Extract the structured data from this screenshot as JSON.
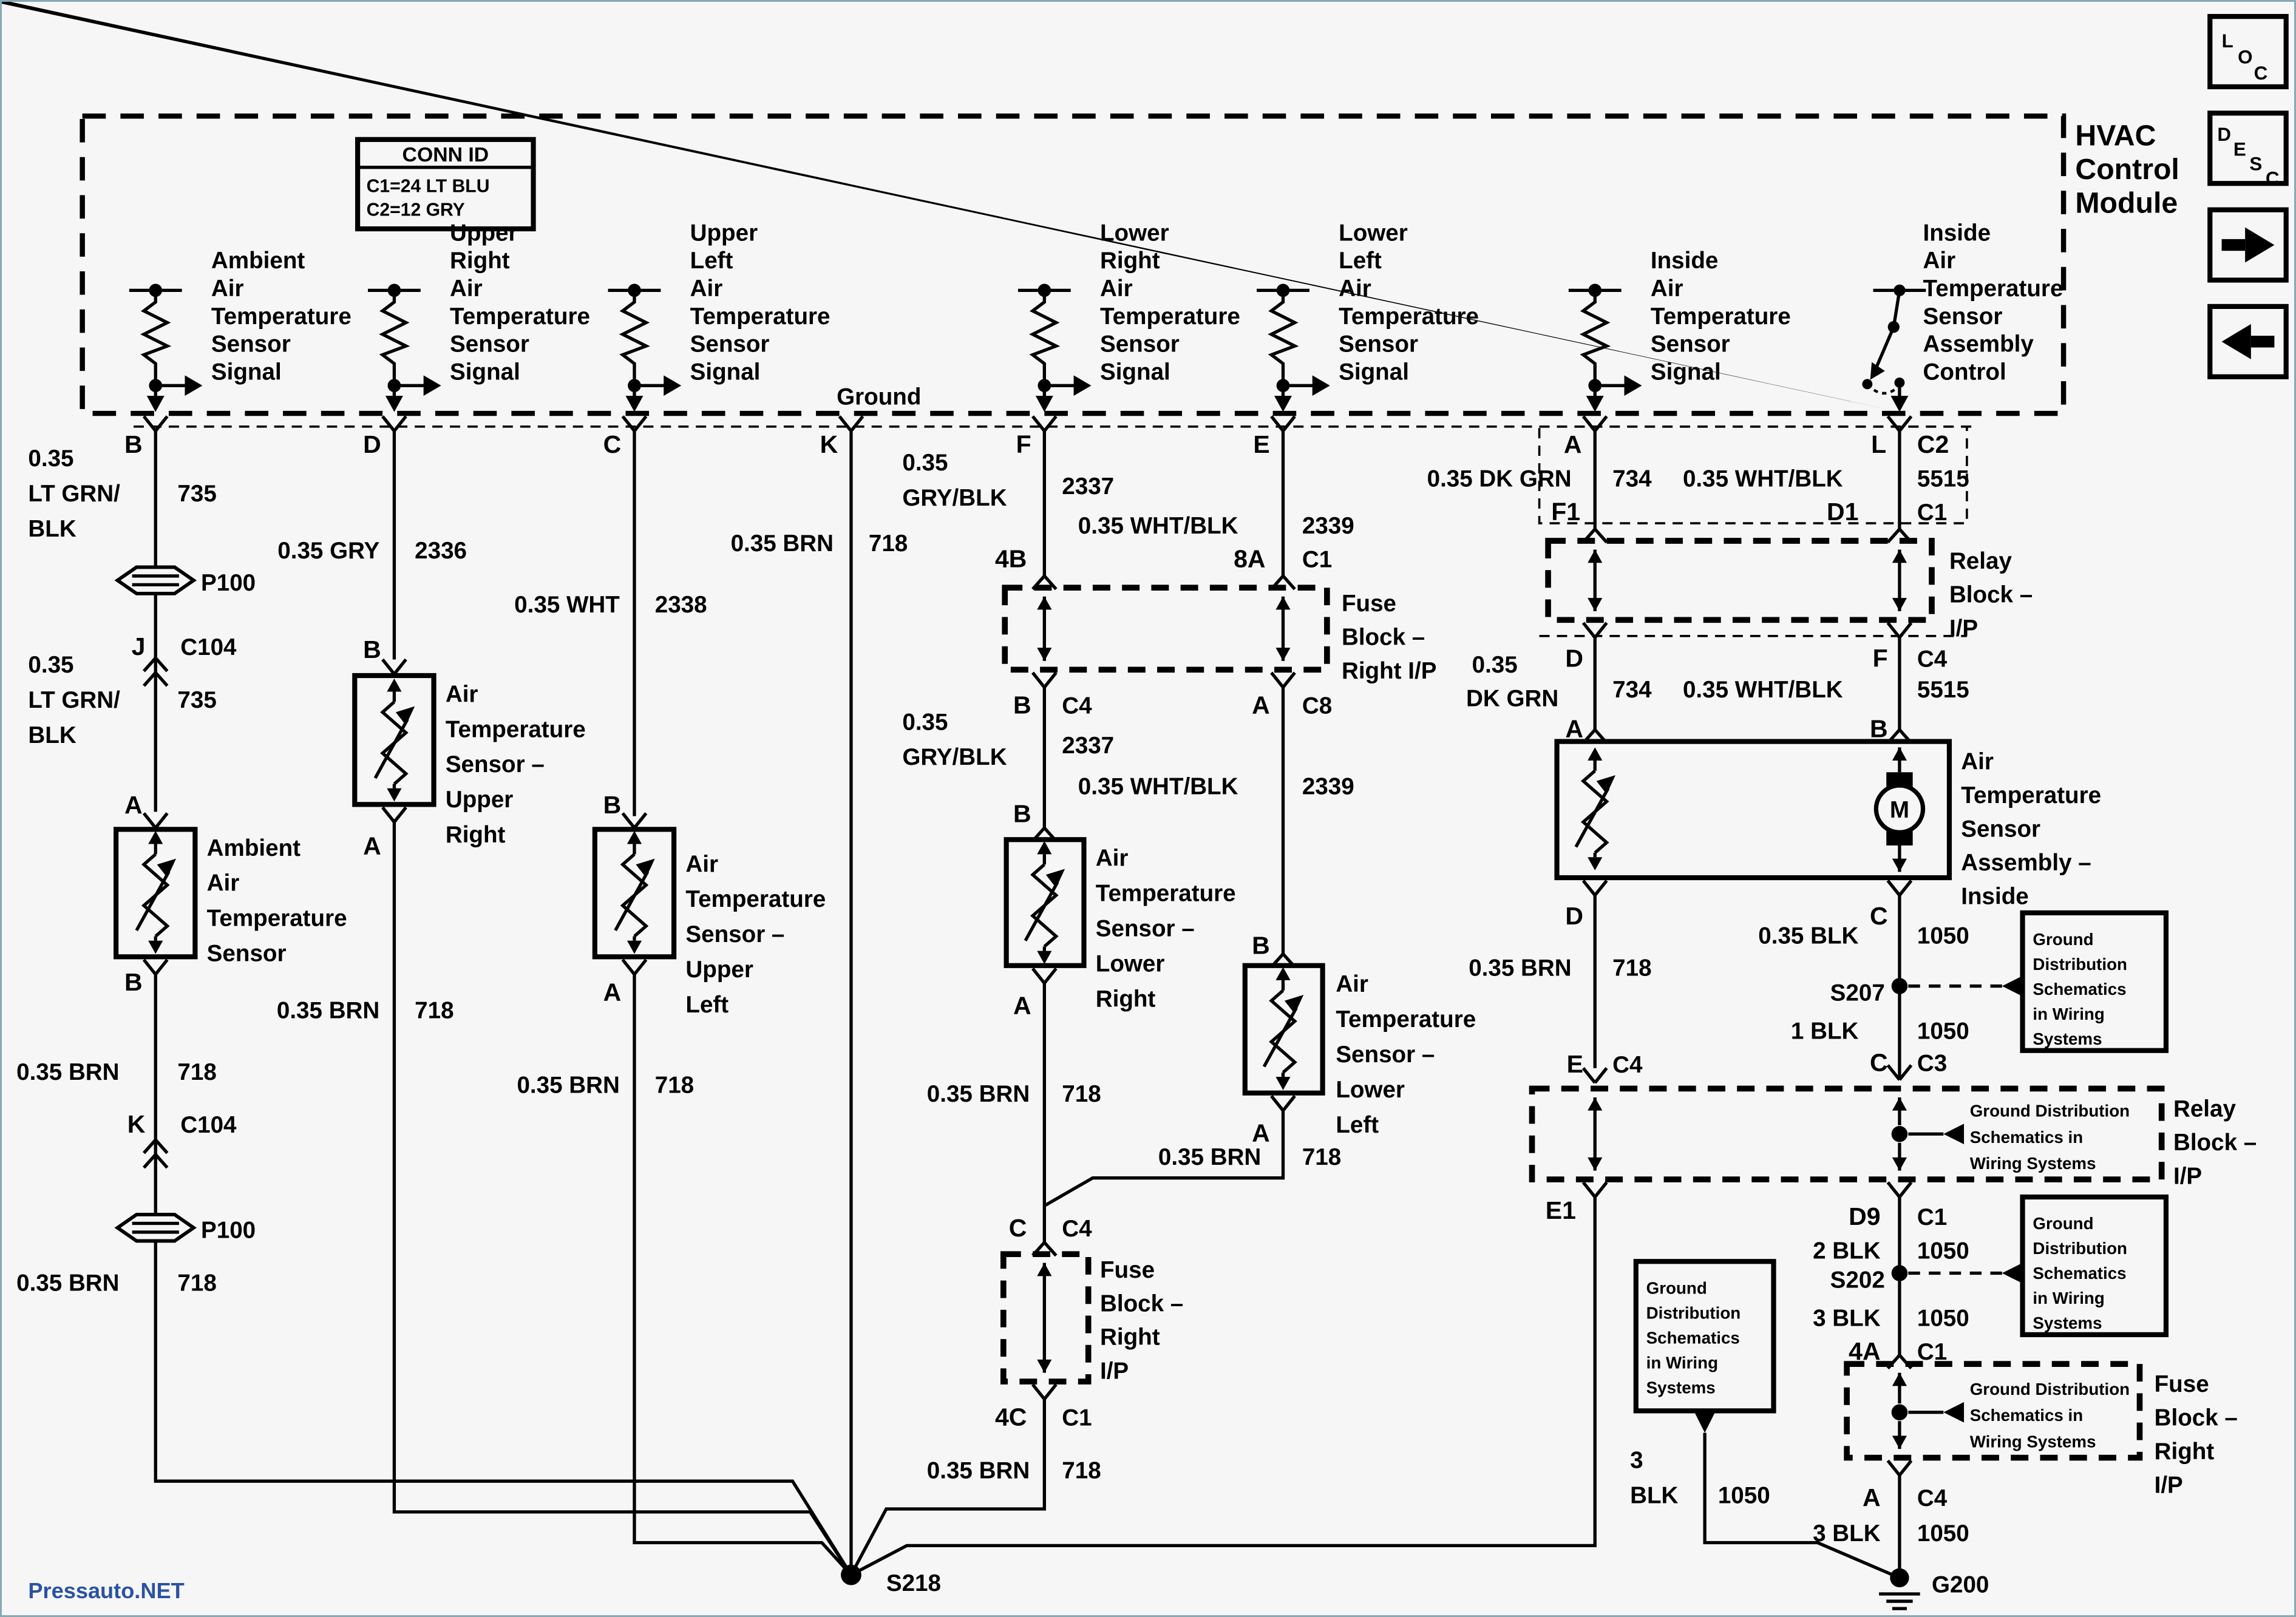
{
  "page": {
    "watermark": "Pressauto.NET",
    "watermark_color": "#2b52a3",
    "background": "#f6f6f6",
    "line_color": "#000000",
    "border_color": "#87a9b3"
  },
  "nav": {
    "loc": [
      "L",
      "O",
      "C"
    ],
    "desc": [
      "D",
      "E",
      "S",
      "C"
    ],
    "next_icon": "right-arrow",
    "prev_icon": "left-arrow"
  },
  "module": {
    "title": [
      "HVAC",
      "Control",
      "Module"
    ]
  },
  "conn": {
    "title": "CONN ID",
    "rows": [
      "C1=24 LT BLU",
      "C2=12 GRY"
    ]
  },
  "signals": {
    "ambient": [
      "Ambient",
      "Air",
      "Temperature",
      "Sensor",
      "Signal"
    ],
    "upper_right": [
      "Upper",
      "Right",
      "Air",
      "Temperature",
      "Sensor",
      "Signal"
    ],
    "upper_left": [
      "Upper",
      "Left",
      "Air",
      "Temperature",
      "Sensor",
      "Signal"
    ],
    "lower_right": [
      "Lower",
      "Right",
      "Air",
      "Temperature",
      "Sensor",
      "Signal"
    ],
    "lower_left": [
      "Lower",
      "Left",
      "Air",
      "Temperature",
      "Sensor",
      "Signal"
    ],
    "inside": [
      "Inside",
      "Air",
      "Temperature",
      "Sensor",
      "Signal"
    ],
    "assembly_control": [
      "Inside",
      "Air",
      "Temperature",
      "Sensor",
      "Assembly",
      "Control"
    ],
    "ground": "Ground"
  },
  "pins": {
    "a": "A",
    "b": "B",
    "c": "C",
    "d": "D",
    "e": "E",
    "f": "F",
    "k": "K",
    "l": "L",
    "j": "J",
    "c1": "C1",
    "c2": "C2",
    "c3": "C3",
    "c4": "C4",
    "c8": "C8",
    "c104": "C104",
    "f1": "F1",
    "d1": "D1",
    "e1": "E1",
    "d9": "D9",
    "p4b": "4B",
    "p8a": "8A",
    "p4c": "4C",
    "p4a": "4A"
  },
  "wires": {
    "sz": "0.35",
    "ltgrn1": "LT GRN/",
    "ltgrn2": "BLK",
    "gry": "0.35 GRY",
    "wht": "0.35 WHT",
    "gryblk": "GRY/BLK",
    "whtblk": "0.35 WHT/BLK",
    "dkgrn": "0.35 DK GRN",
    "dkgrn2": "DK GRN",
    "brn": "0.35 BRN",
    "blk035": "0.35 BLK",
    "blk1": "1 BLK",
    "blk2": "2 BLK",
    "blk3": "3 BLK",
    "blk3a": "3",
    "blk3b": "BLK",
    "n735": "735",
    "n718": "718",
    "n734": "734",
    "n1050": "1050",
    "n2336": "2336",
    "n2337": "2337",
    "n2338": "2338",
    "n2339": "2339",
    "n5515": "5515"
  },
  "splices": {
    "s218": "S218",
    "s207": "S207",
    "s202": "S202",
    "g200": "G200",
    "p100": "P100"
  },
  "comp": {
    "ambient": [
      "Ambient",
      "Air",
      "Temperature",
      "Sensor"
    ],
    "upper_right": [
      "Air",
      "Temperature",
      "Sensor –",
      "Upper",
      "Right"
    ],
    "upper_left": [
      "Air",
      "Temperature",
      "Sensor –",
      "Upper",
      "Left"
    ],
    "lower_right": [
      "Air",
      "Temperature",
      "Sensor –",
      "Lower",
      "Right"
    ],
    "lower_left": [
      "Air",
      "Temperature",
      "Sensor –",
      "Lower",
      "Left"
    ],
    "assembly": [
      "Air",
      "Temperature",
      "Sensor",
      "Assembly –",
      "Inside"
    ],
    "motor": "M"
  },
  "blocks": {
    "fuse3": [
      "Fuse",
      "Block –",
      "Right I/P"
    ],
    "fuse4": [
      "Fuse",
      "Block –",
      "Right",
      "I/P"
    ],
    "relay": [
      "Relay",
      "Block –",
      "I/P"
    ]
  },
  "notes": {
    "gd5": [
      "Ground",
      "Distribution",
      "Schematics",
      "in Wiring",
      "Systems"
    ],
    "gd3": [
      "Ground Distribution",
      "Schematics in",
      "Wiring Systems"
    ]
  }
}
